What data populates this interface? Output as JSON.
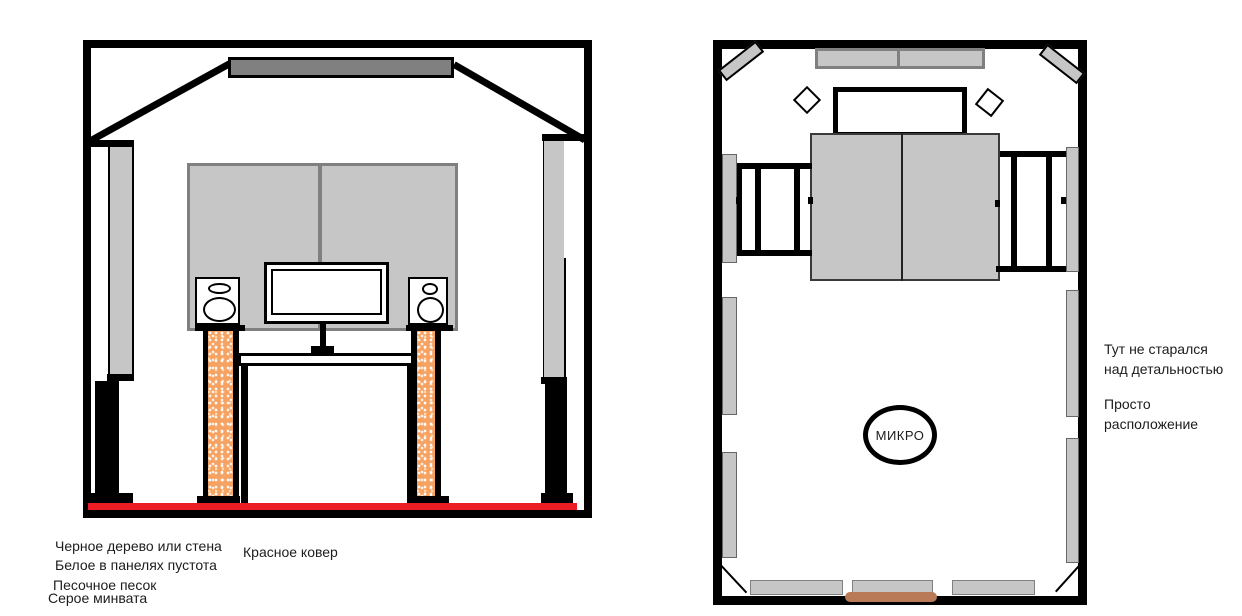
{
  "colors": {
    "ink": "#000000",
    "paper": "#FFFFFF",
    "carpet-red": "#EC1C24",
    "panel-gray": "#C6C6C6",
    "mid-gray": "#808080",
    "sand-orange": "#F5A263",
    "door-brown": "#B97A57",
    "text": "#1C1C1C"
  },
  "elevation": {
    "legend": [
      "Черное дерево или стена",
      "Белое в панелях пустота",
      "Песочное песок",
      "Серое минвата"
    ],
    "carpet_label": "Красное ковер"
  },
  "plan": {
    "mic_label": "МИКРО",
    "notes": [
      {
        "line1": "Тут не старался",
        "line2": "над детальностью"
      },
      {
        "line1": "Просто",
        "line2": "расположение"
      }
    ]
  }
}
